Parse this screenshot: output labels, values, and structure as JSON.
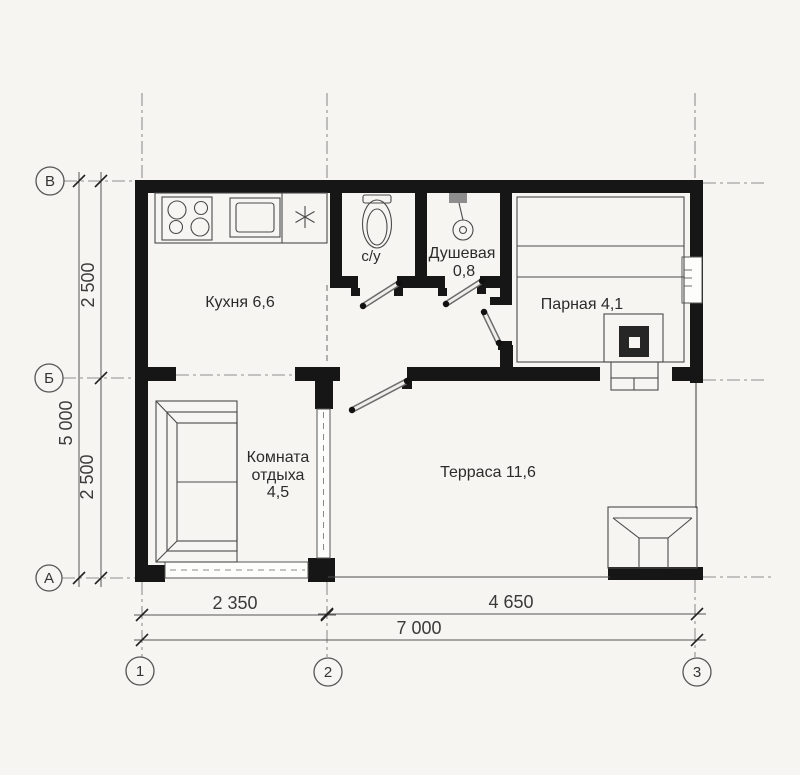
{
  "rooms": {
    "kitchen": {
      "label": "Кухня 6,6"
    },
    "wc": {
      "label": "с/у"
    },
    "shower": {
      "name_line": "Душевая",
      "area_line": "0,8"
    },
    "steam": {
      "label": "Парная 4,1"
    },
    "rest": {
      "line1": "Комната",
      "line2": "отдыха",
      "line3": "4,5"
    },
    "terrace": {
      "label": "Терраса 11,6"
    }
  },
  "axes": {
    "rows": [
      "В",
      "Б",
      "А"
    ],
    "cols": [
      "1",
      "2",
      "3"
    ]
  },
  "dims": {
    "bottom_left": "2 350",
    "bottom_right": "4 650",
    "bottom_total": "7 000",
    "left_top": "2 500",
    "left_bottom": "2 500",
    "left_total": "5 000"
  },
  "colors": {
    "wall": "#161616",
    "thin_line": "#4a4a4a",
    "axis_line": "#8f8f8f",
    "background": "#f6f5f2",
    "text": "#2b2b2b"
  }
}
